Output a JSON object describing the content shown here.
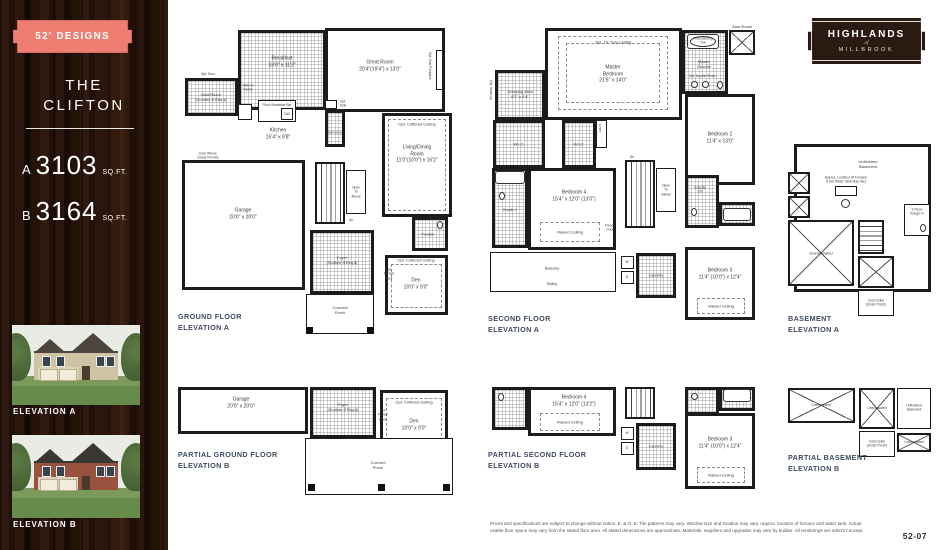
{
  "sidebar": {
    "badge_label": "52' DESIGNS",
    "title": "THE\nCLIFTON",
    "specs": [
      {
        "variant": "A",
        "sqft": "3103",
        "unit": "SQ.FT."
      },
      {
        "variant": "B",
        "sqft": "3164",
        "unit": "SQ.FT."
      }
    ],
    "elevation_a_label": "ELEVATION A",
    "elevation_b_label": "ELEVATION B"
  },
  "logo": {
    "line1": "HIGHLANDS",
    "line2": "of",
    "line3": "MILLBROOK"
  },
  "plans": {
    "ground_a": {
      "title": "GROUND FLOOR\nELEVATION A",
      "labels": {
        "opt_door": "Opt. Door",
        "breakfast": "Breakfast\n13'0\" x 11'2\"",
        "great_room": "Great Room\n20'4\"(19'4\") x 13'0\"",
        "fireplace": "Opt. Gas Fireplace",
        "mud_room": "Mud Room\n(Sunken If Req'd)",
        "pantry": "Walk-In\nPantry",
        "island": "Flush Breakfast Bar",
        "dw": "DW",
        "kitchen": "Kitchen\n15'4\" x 9'8\"",
        "servery": "Servery",
        "opt_sink": "Opt.\nSink",
        "living": "Living/Dining\nRoom\n11'0\"(10'0\") x 16'2\"",
        "coffered_living": "Opt. Coffered Ceiling",
        "garage": "Garage\n20'0\" x 20'0\"",
        "grade_door": "Door Where\nGrade Permits",
        "up": "Up",
        "open_above": "Open\nTo\nAbove",
        "foyer": "Foyer\n(Sunken If Req'd)",
        "powder": "Powder",
        "den": "Den\n10'0\" x 9'0\"",
        "coffered_den": "Opt. Coffered Ceiling",
        "french_door": "Opt.\nFrench\nDoor",
        "porch": "Covered\nPorch"
      }
    },
    "second_a": {
      "title": "SECOND FLOOR\nELEVATION A",
      "labels": {
        "tray": "Opt. 10' Tray Ceiling",
        "master": "Master\nBedroom\n21'6\" x 14'0\"",
        "dressing": "Dressing Area\n8'2\" x 6'4\"",
        "makeup": "Opt. Make-up",
        "tub": "Freestanding\nTub",
        "shower": "Glass Shower",
        "ensuite": "Master\nEnsuite",
        "double_sinks": "Opt. Double Sinks",
        "bedroom2": "Bedroom 2\n11'4\" x 13'0\"",
        "wic1": "W.I.C.",
        "wic2": "W.I.C.",
        "linen": "Linen",
        "ensuite4": "Ensuite 4",
        "bedroom4": "Bedroom 4\n15'4\" x 12'0\" (13'0\")",
        "raised4": "Raised Ceiling",
        "french_door": "French\nDoor",
        "balcony": "Balcony",
        "railing": "Railing",
        "dn": "Dn",
        "open_below": "Open\nTo\nBelow",
        "washer": "W",
        "dryer": "D",
        "laundry": "Laundry",
        "ensuite23": "Ensuite\n2/3",
        "bedroom3": "Bedroom 3\n11'4\" (10'0\") x 12'4\"",
        "raised3": "Raised Ceiling"
      }
    },
    "basement_a": {
      "title": "BASEMENT\nELEVATION A",
      "labels": {
        "unfinished": "Unfinished\nBasement",
        "furnace": "Approx. Location Of Furnace\n& Hot Water Tank May Vary",
        "unexcavated": "Unexcavated",
        "cold_cellar": "Cold Cellar\n(Under Porch)",
        "rough_in": "3 Piece\nRough-In"
      }
    },
    "partial_ground_b": {
      "title": "PARTIAL GROUND FLOOR\nELEVATION B",
      "labels": {
        "garage": "Garage\n20'0\" x 20'0\"",
        "foyer": "Foyer\n(Sunken If Req'd)",
        "den": "Den\n10'0\" x 9'0\"",
        "coffered_den": "Opt. Coffered Ceiling",
        "french_door": "Opt.\nFrench\nDoor",
        "porch": "Covered\nPorch"
      }
    },
    "partial_second_b": {
      "title": "PARTIAL SECOND FLOOR\nELEVATION B",
      "labels": {
        "bedroom4": "Bedroom 4\n15'4\" x 12'0\" (13'2\")",
        "raised4": "Raised Ceiling",
        "washer": "W",
        "dryer": "D",
        "laundry": "Laundry",
        "bedroom3": "Bedroom 3\n11'4\" (10'0\") x 12'4\"",
        "raised3": "Raised Ceiling"
      }
    },
    "partial_basement_b": {
      "title": "PARTIAL BASEMENT\nELEVATION B",
      "labels": {
        "unexcavated1": "Unexcavated",
        "unexcavated2": "Unexcavated",
        "unfinished": "Unfinished\nBasement",
        "cold_cellar": "Cold Cellar\n(Under Porch)",
        "unexcavated3": "Unexcavated"
      }
    }
  },
  "footer": {
    "disclaimer": "Prices and specifications are subject to change without notice. E. & O. E. Tile patterns may vary. Window size and location may vary. Approx. location of furnace and water tank. Actual usable floor space may vary from the stated floor area. All stated dimensions are approximate. Materials, suppliers and upgrades may vary by builder. All renderings are artist's concept.",
    "page_number": "52-07"
  },
  "colors": {
    "badge_coral": "#EE7E72",
    "wood_dark": "#1F110B",
    "logo_brown": "#2A1A12",
    "plan_title_navy": "#3D4A5F"
  }
}
